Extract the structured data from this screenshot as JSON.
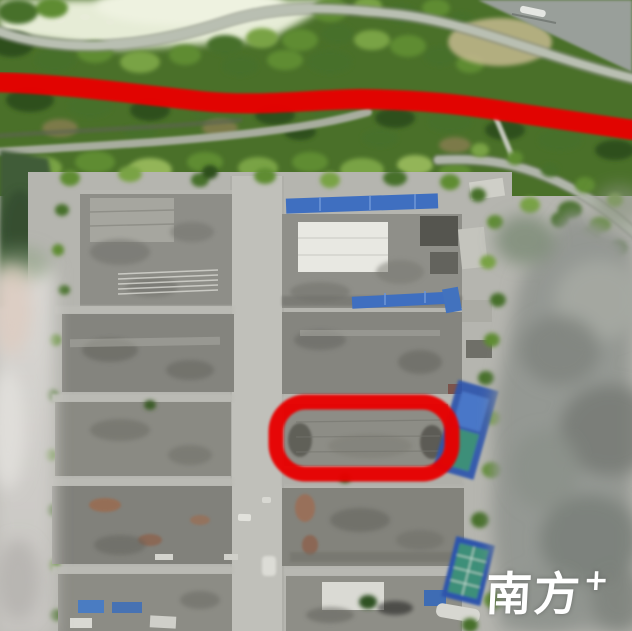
{
  "watermark": {
    "text": "南方",
    "plus": "+",
    "color": "#ffffff"
  },
  "annotations": {
    "route_line": "hand-drawn red marker line along riverside road",
    "building_highlight": "hand-drawn red rounded rectangle around demolished rooftop"
  },
  "palette": {
    "vegetation_green": "#4a7029",
    "ground_gray": "#b5b5af",
    "building_gray": "#8b8b84",
    "roof_white": "#e8e8e2",
    "roof_blue": "#3f6fc0",
    "court_blue": "#2d54ac",
    "court_teal": "#3e8f79",
    "river_gray": "#999f9a",
    "canal_green": "#3f5c39",
    "blur_gray": "#949893",
    "annotation_red": "#e80000",
    "watermark_white": "#ffffff"
  }
}
